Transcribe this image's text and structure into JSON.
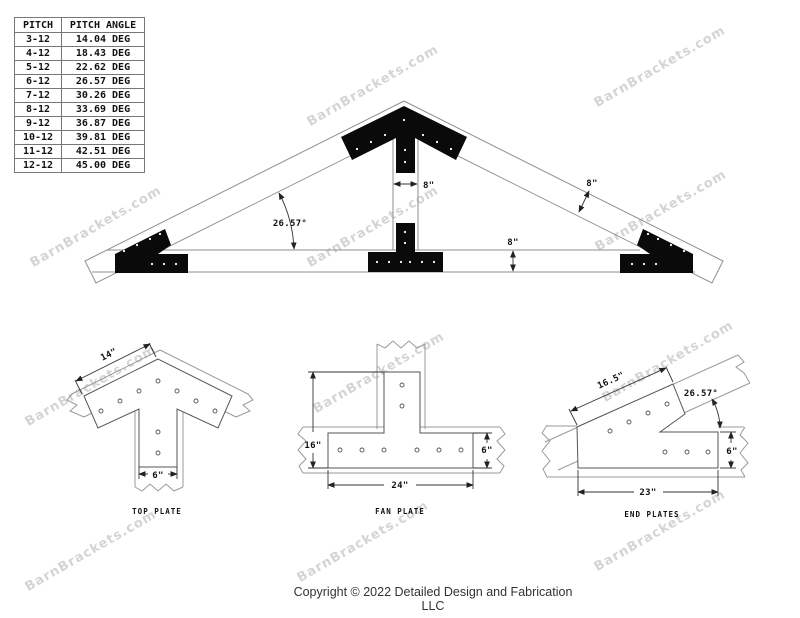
{
  "watermark": {
    "text": "BarnBrackets.com"
  },
  "pitch_table": {
    "headers": [
      "PITCH",
      "PITCH ANGLE"
    ],
    "rows": [
      [
        "3-12",
        "14.04 DEG"
      ],
      [
        "4-12",
        "18.43 DEG"
      ],
      [
        "5-12",
        "22.62 DEG"
      ],
      [
        "6-12",
        "26.57 DEG"
      ],
      [
        "7-12",
        "30.26 DEG"
      ],
      [
        "8-12",
        "33.69 DEG"
      ],
      [
        "9-12",
        "36.87 DEG"
      ],
      [
        "10-12",
        "39.81 DEG"
      ],
      [
        "11-12",
        "42.51 DEG"
      ],
      [
        "12-12",
        "45.00 DEG"
      ]
    ]
  },
  "truss_diagram": {
    "angle_label": "26.57°",
    "king_post_width_label": "8\"",
    "rafter_width_label": "8\"",
    "chord_height_label": "8\""
  },
  "details": {
    "top_plate": {
      "label": "TOP PLATE",
      "edge_dim": "14\"",
      "bottom_dim": "6\""
    },
    "fan_plate": {
      "label": "FAN PLATE",
      "height_dim": "16\"",
      "bar_height_dim": "6\"",
      "width_dim": "24\""
    },
    "end_plates": {
      "label": "END PLATES",
      "edge_dim": "16.5\"",
      "angle_dim": "26.57°",
      "height_dim": "6\"",
      "width_dim": "23\""
    }
  },
  "footer": {
    "copyright": "Copyright © 2022 Detailed Design and Fabrication LLC"
  }
}
